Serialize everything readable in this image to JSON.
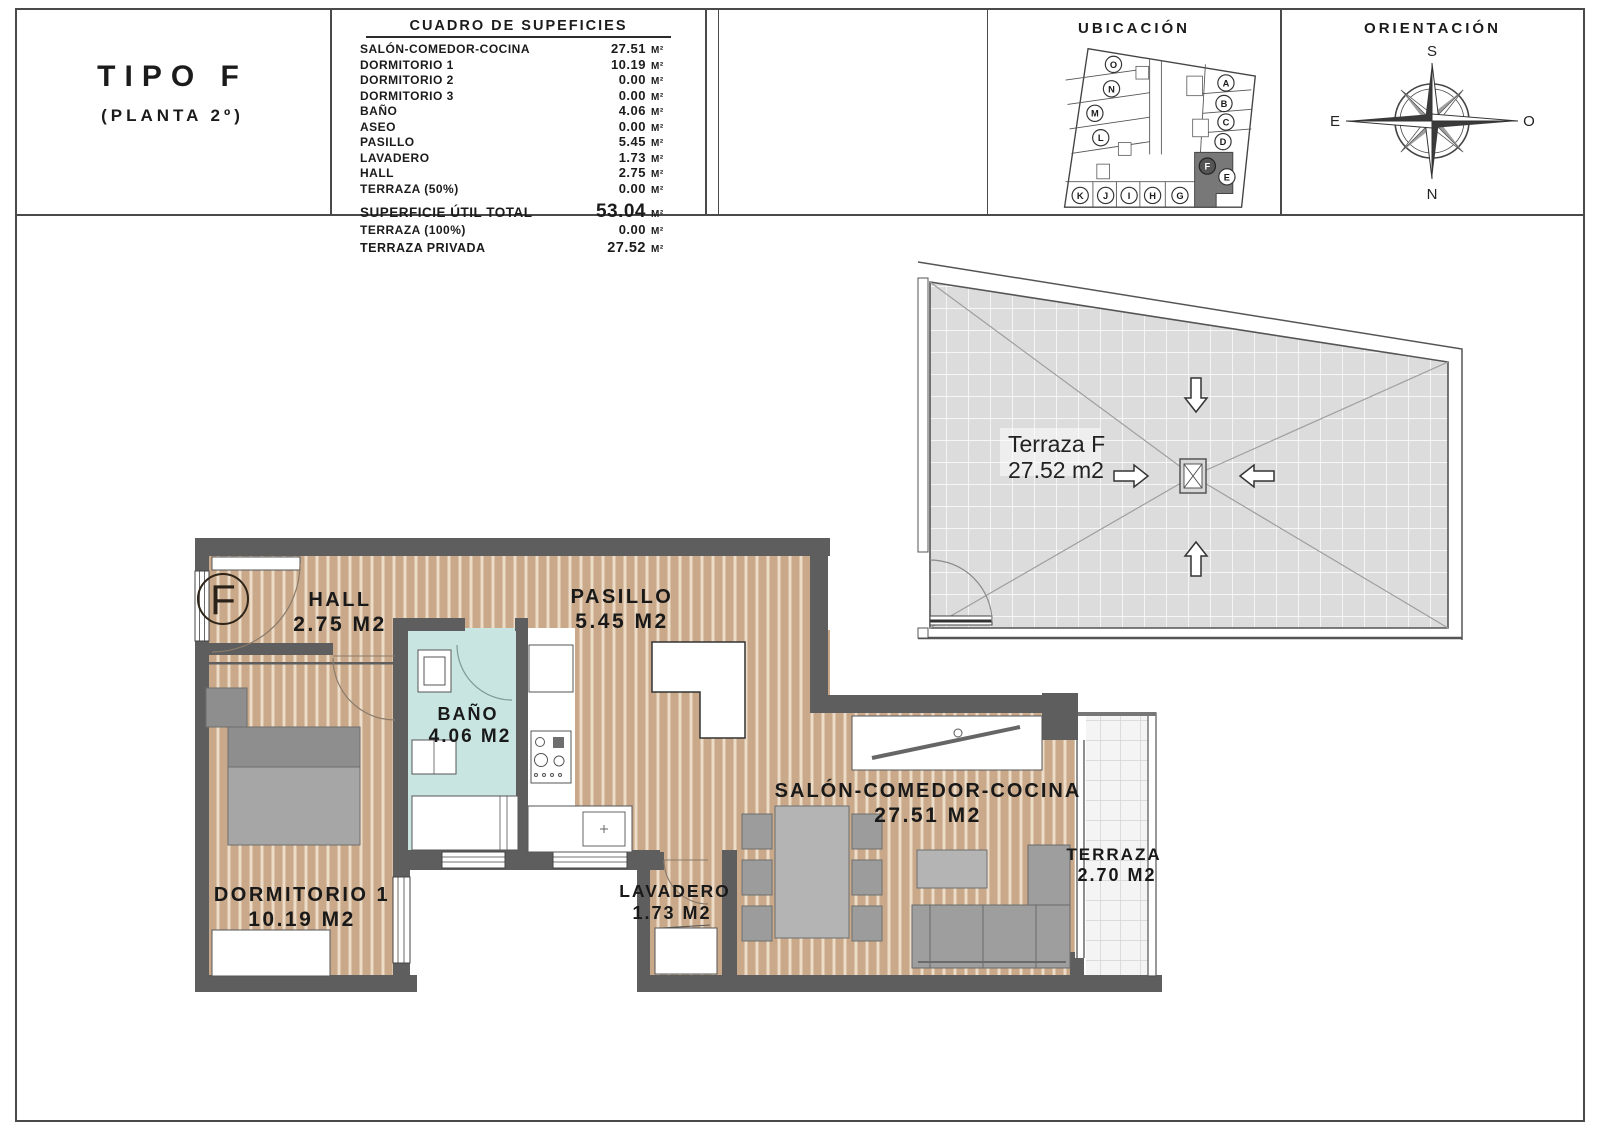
{
  "header": {
    "type_title": "TIPO F",
    "type_subtitle": "(PLANTA 2º)",
    "surface_table": {
      "title": "CUADRO DE SUPEFICIES",
      "rows": [
        {
          "label": "SALÓN-COMEDOR-COCINA",
          "value": "27.51",
          "unit": "M²"
        },
        {
          "label": "DORMITORIO 1",
          "value": "10.19",
          "unit": "M²"
        },
        {
          "label": "DORMITORIO 2",
          "value": "0.00",
          "unit": "M²"
        },
        {
          "label": "DORMITORIO 3",
          "value": "0.00",
          "unit": "M²"
        },
        {
          "label": "BAÑO",
          "value": "4.06",
          "unit": "M²"
        },
        {
          "label": "ASEO",
          "value": "0.00",
          "unit": "M²"
        },
        {
          "label": "PASILLO",
          "value": "5.45",
          "unit": "M²"
        },
        {
          "label": "LAVADERO",
          "value": "1.73",
          "unit": "M²"
        },
        {
          "label": "HALL",
          "value": "2.75",
          "unit": "M²"
        },
        {
          "label": "TERRAZA (50%)",
          "value": "0.00",
          "unit": "M²"
        }
      ],
      "total_row": {
        "label": "SUPERFICIE ÚTIL TOTAL",
        "value": "53.04",
        "unit": "M²"
      },
      "extra_rows": [
        {
          "label": "TERRAZA (100%)",
          "value": "0.00",
          "unit": "M²"
        },
        {
          "label": "TERRAZA PRIVADA",
          "value": "27.52",
          "unit": "M²"
        }
      ]
    },
    "ubicacion": {
      "title": "UBICACIÓN",
      "units": [
        "O",
        "N",
        "M",
        "L",
        "A",
        "B",
        "C",
        "D",
        "E",
        "F",
        "K",
        "J",
        "I",
        "H",
        "G"
      ],
      "highlighted_unit": "F"
    },
    "orientacion": {
      "title": "ORIENTACIÓN",
      "labels": {
        "top": "S",
        "bottom": "N",
        "left": "E",
        "right": "O"
      }
    }
  },
  "roof_terrace": {
    "name": "Terraza F",
    "area": "27.52 m2"
  },
  "floor_plan": {
    "unit_label": "F",
    "rooms": [
      {
        "name": "HALL",
        "area": "2.75 M2"
      },
      {
        "name": "PASILLO",
        "area": "5.45 M2"
      },
      {
        "name": "BAÑO",
        "area": "4.06 M2"
      },
      {
        "name": "DORMITORIO 1",
        "area": "10.19 M2"
      },
      {
        "name": "LAVADERO",
        "area": "1.73 M2"
      },
      {
        "name": "SALÓN-COMEDOR-COCINA",
        "area": "27.51 M2"
      },
      {
        "name": "TERRAZA",
        "area": "2.70 M2"
      }
    ]
  },
  "colors": {
    "wall": "#5e5e5e",
    "wood_floor": "#c9a98a",
    "bath_floor": "#c9e5e1",
    "roof_terrace_fill": "#dcdcdc",
    "line": "#4a4a4a",
    "highlight_unit": "#787878"
  }
}
